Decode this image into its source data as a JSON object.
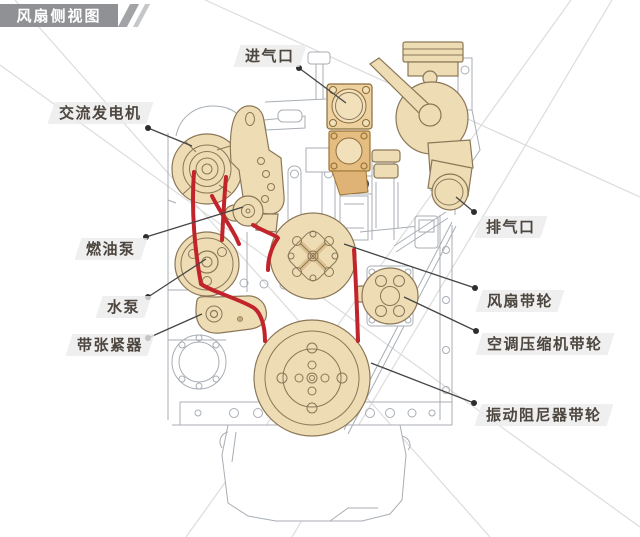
{
  "title": "风扇侧视图",
  "labels": {
    "intake": "进气口",
    "alternator": "交流发电机",
    "fuel_pump": "燃油泵",
    "water_pump": "水泵",
    "belt_tensioner": "带张紧器",
    "exhaust": "排气口",
    "fan_pulley": "风扇带轮",
    "ac_compressor_pulley": "空调压缩机带轮",
    "vibration_damper_pulley": "振动阻尼器带轮"
  },
  "colors": {
    "part_fill": "#eedcb5",
    "part_outline": "#8b7757",
    "belt_red": "#c2242b",
    "line_gray": "#a8aeb4",
    "label_text": "#4c463f",
    "title_bg": "#909194",
    "title_text": "#ffffff"
  },
  "diagram": {
    "type": "engine-fan-side-view",
    "highlighted_parts": [
      "进气口",
      "交流发电机",
      "燃油泵",
      "水泵",
      "带张紧器",
      "排气口",
      "风扇带轮",
      "空调压缩机带轮",
      "振动阻尼器带轮"
    ]
  }
}
